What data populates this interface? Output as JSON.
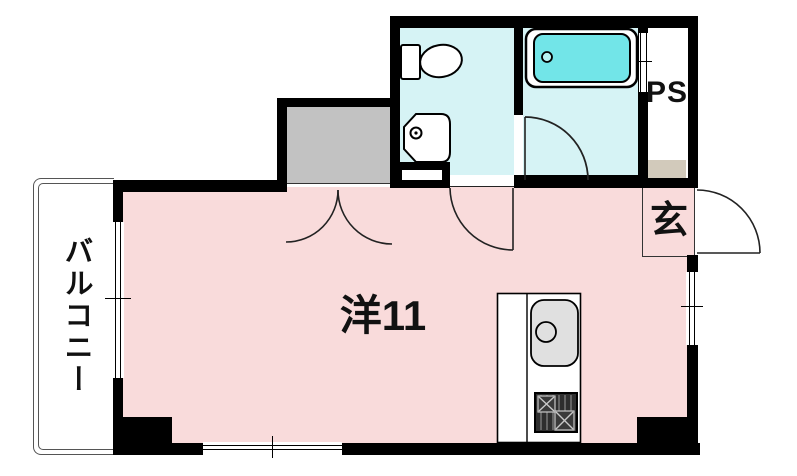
{
  "labels": {
    "main_room": "洋11",
    "balcony": "バルコニー",
    "entrance": "玄",
    "pipe_space": "PS"
  },
  "colors": {
    "room_pink": "#f9dbdb",
    "wet_area_cyan": "#d6f3f5",
    "bathtub_cyan": "#72e5e8",
    "closet_gray": "#c2c2c2",
    "step_beige": "#d2cabb",
    "counter_white": "#ffffff",
    "sink_gray": "#e0e0e0",
    "wall_black": "#000000"
  },
  "fixtures": [
    "toilet-icon",
    "washbasin-icon",
    "bathtub-icon",
    "kitchen-sink-icon",
    "gas-stove-icon",
    "closet",
    "double-door",
    "toilet-room-door",
    "bathroom-door",
    "entrance-door",
    "balcony-window",
    "bottom-window",
    "side-window"
  ]
}
